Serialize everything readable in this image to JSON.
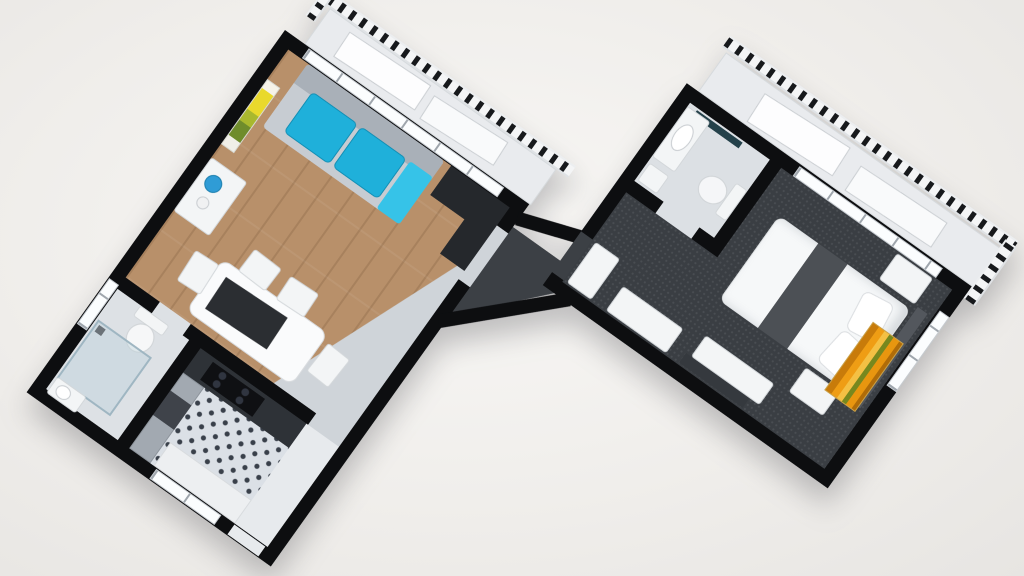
{
  "scene": {
    "type": "3d-floor-plan-render",
    "description": "Top-down 3D render of a two-unit apartment floor plan rotated diagonally on a white background",
    "rotation_deg": 35.5,
    "background": "#f0eeeb"
  },
  "palette": {
    "wall": "#0d0e10",
    "wood_floor": "#b8906a",
    "entry_floor": "#cfd4d9",
    "bath_tile": "#dde1e5",
    "kitchen_tile": "#dbe0e6",
    "kitchen_tile_dot": "#39404a",
    "carpet_dark": "#3a3e43",
    "balcony_floor": "#e9ebee",
    "railing_post": "#17191c",
    "sofa_grey": "#c7ccd2",
    "cushion_teal": "#1fb0da",
    "throw_teal": "#36c3e8",
    "vase_blue": "#2f9cd6",
    "desk_black": "#25282c",
    "counter_dark": "#2e3237",
    "picture_yellow": "#e9d92c",
    "picture_green": "#6f8c2c",
    "artwork_orange": "#ef9d14",
    "artwork_green": "#77881e",
    "bed_white": "#f6f8f9",
    "bed_runner_grey": "#4c5055",
    "tv_dark": "#35393e"
  },
  "rooms": {
    "living_room": "living room with wood floor",
    "kitchen": "kitchen with checkered tile floor",
    "bathroom_left": "bathroom with shower",
    "entry_left": "entry area",
    "balcony_left": "balcony with railing",
    "bedroom": "bedroom with dark carpet",
    "bathroom_right": "small bathroom",
    "hall_right": "entrance hall",
    "balcony_right": "balcony with railing",
    "connector": "connecting hallway"
  },
  "furniture": {
    "living_room": [
      "grey sofa with teal cushions",
      "teal throw",
      "yellow flower wall picture",
      "white sideboard with blue vase",
      "black corner desk",
      "white dining table with dark runner",
      "four white chairs"
    ],
    "kitchen": [
      "dark counter with cooktop",
      "side counter",
      "dark appliance",
      "lower cabinet",
      "window"
    ],
    "bathroom_left": [
      "toilet",
      "glass shower enclosure",
      "washbasin",
      "window"
    ],
    "bedroom": [
      "double bed with dark grey runner",
      "two white pillows",
      "dark headboard",
      "two nightstands",
      "bamboo artwork",
      "tv panel",
      "tv stand",
      "wardrobe",
      "white sideboard"
    ],
    "bathroom_right": [
      "vanity with basin",
      "wall mirror",
      "toilet",
      "small white unit"
    ]
  }
}
